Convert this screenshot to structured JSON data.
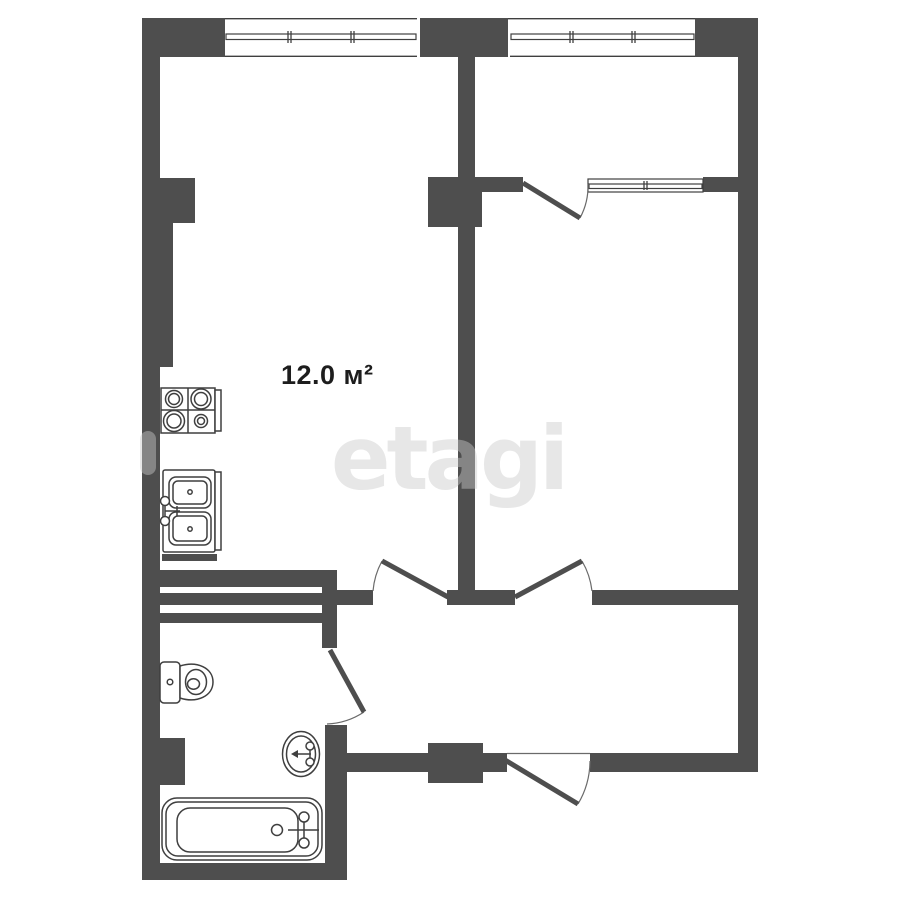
{
  "labels": {
    "room_area": "12.0 м²"
  },
  "watermark": {
    "text": "etagi"
  },
  "colors": {
    "wall": "#4e4e4e",
    "line": "#3f3f3f",
    "watermark": "#c9c9c9",
    "label": "#1d1d1d",
    "bg": "#ffffff"
  },
  "fixtures": [
    "stove-icon",
    "kitchen-sink-icon",
    "toilet-icon",
    "washbasin-icon",
    "bathtub-icon"
  ],
  "openings": {
    "doors": [
      "kitchen-door",
      "bedroom-door",
      "balcony-door",
      "bathroom-door",
      "entrance-door"
    ],
    "windows": [
      "kitchen-window",
      "balcony-window",
      "balcony-bedroom-window"
    ]
  }
}
